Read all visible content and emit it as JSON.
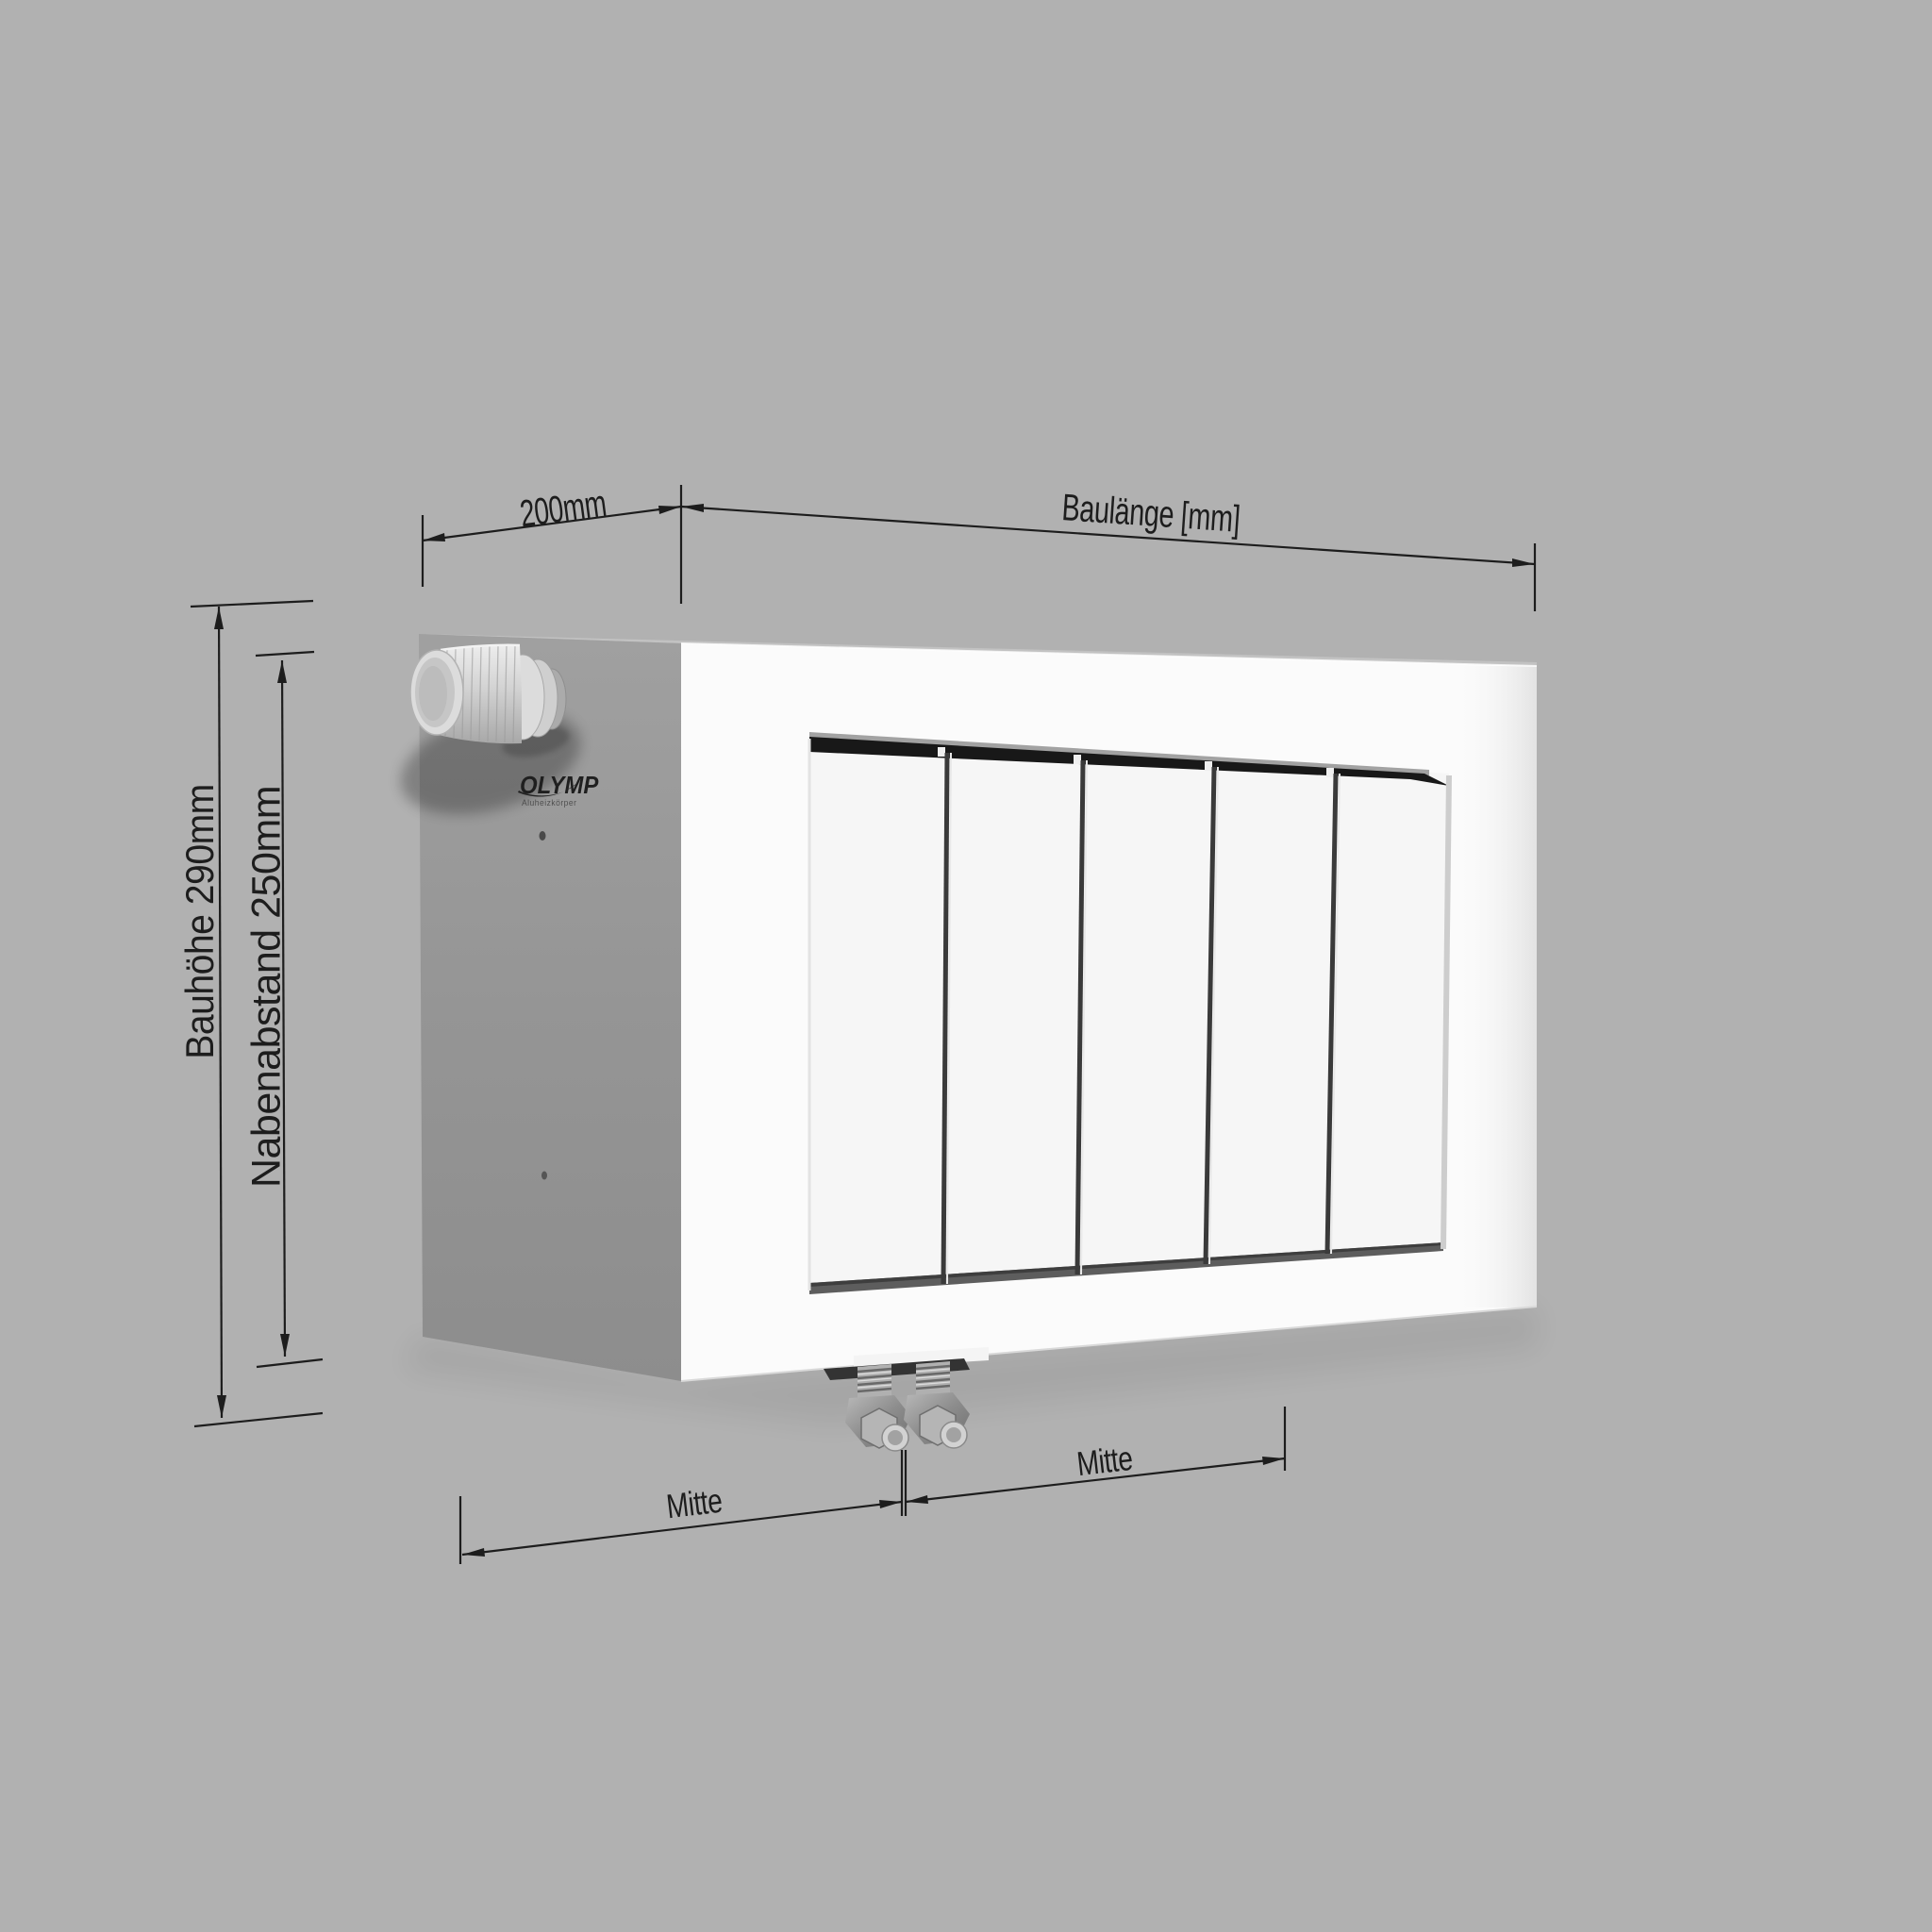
{
  "title": "Radiator technical dimension drawing",
  "colors": {
    "background": "#b1b1b1",
    "dimension_lines": "#1d1d1d",
    "front_face": "#fbfbfb",
    "side_face": "#969696",
    "top_slot": "#181818"
  },
  "brand": {
    "name": "OLYMP",
    "tagline": "Aluheizkörper"
  },
  "dimensions": {
    "depth": {
      "label": "200mm"
    },
    "length": {
      "label": "Baulänge [mm]"
    },
    "height": {
      "label": "Bauhöhe 290mm"
    },
    "hub_distance": {
      "label": "Nabenabstand 250mm"
    },
    "center_left": {
      "label": "Mitte"
    },
    "center_right": {
      "label": "Mitte"
    }
  },
  "radiator": {
    "fin_count": 5,
    "valve_count": 2
  }
}
